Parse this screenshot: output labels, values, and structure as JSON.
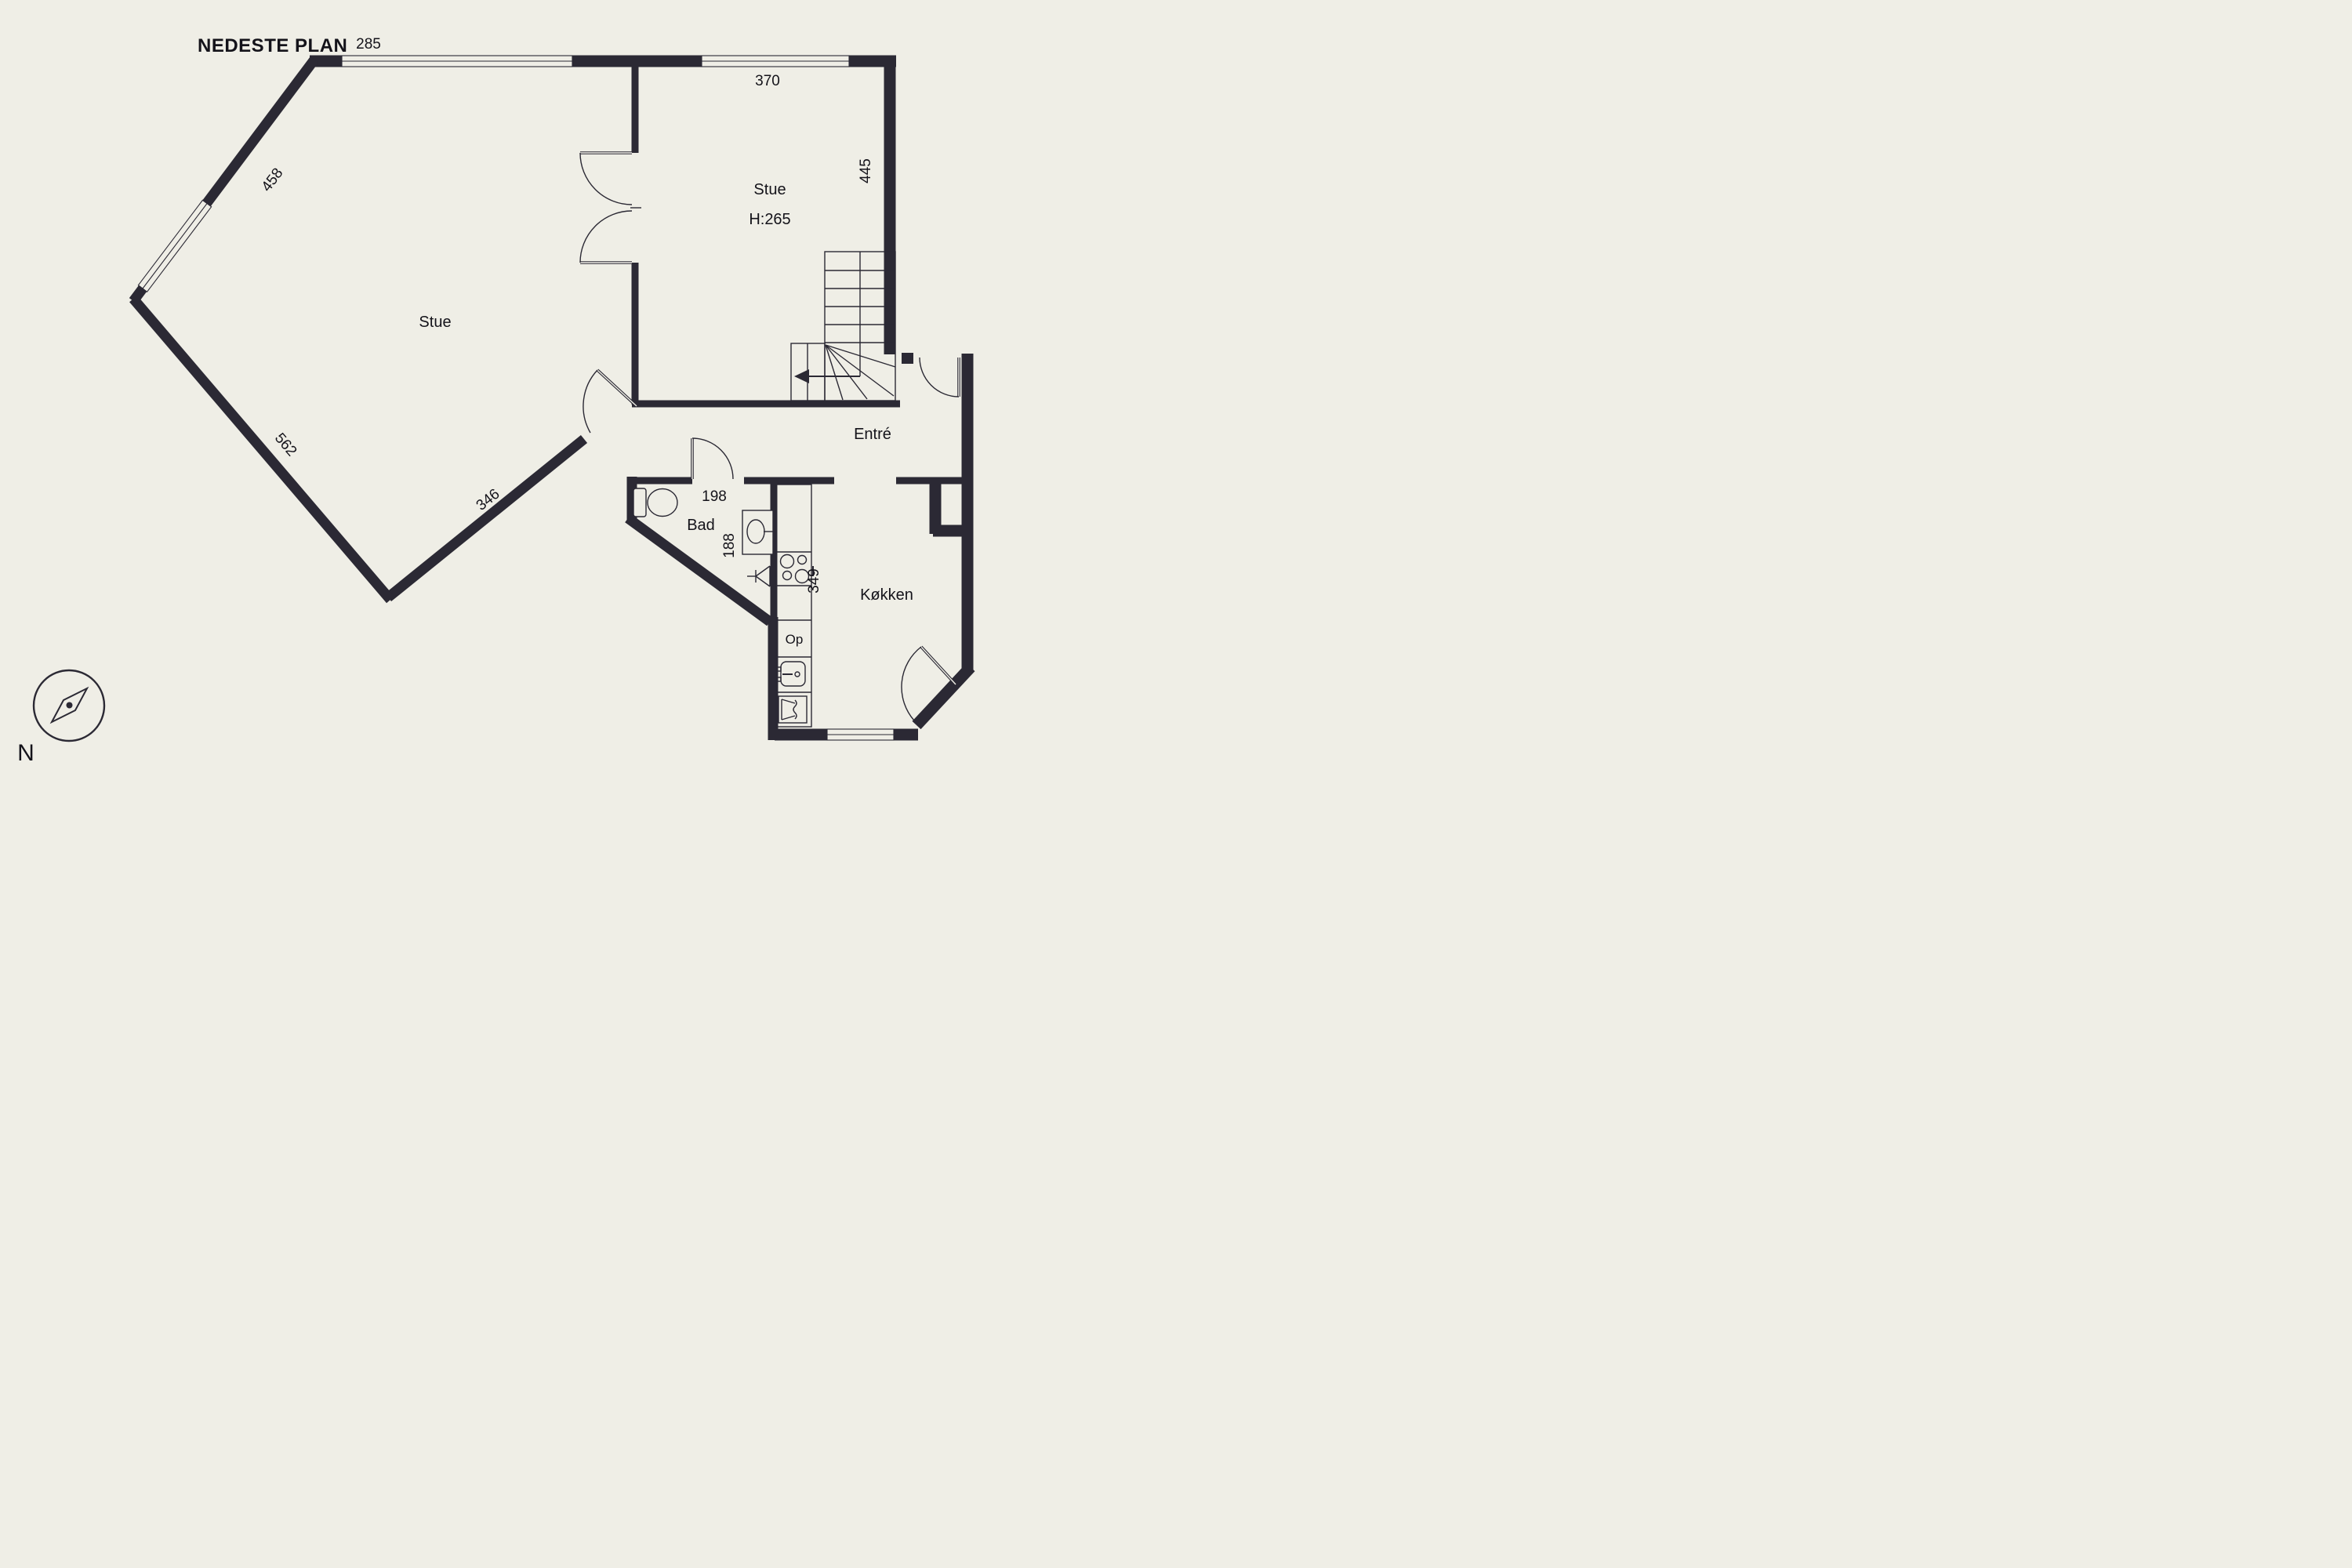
{
  "title": "NEDESTE PLAN",
  "compass": {
    "north": "N"
  },
  "rooms": {
    "stue_main": "Stue",
    "stue_upper": "Stue",
    "stue_upper_height": "H:265",
    "entre": "Entré",
    "bad": "Bad",
    "kitchen": "Køkken",
    "stairs_up": "Op"
  },
  "dimensions": {
    "win_top": "285",
    "win_upper_right": "370",
    "wall_right": "445",
    "wall_nw": "458",
    "wall_sw": "562",
    "wall_se": "346",
    "bad_width": "198",
    "bad_depth": "188",
    "kitchen_wall": "349"
  },
  "colors": {
    "background": "#efeee6",
    "walls": "#2b2934",
    "text": "#14131a"
  }
}
